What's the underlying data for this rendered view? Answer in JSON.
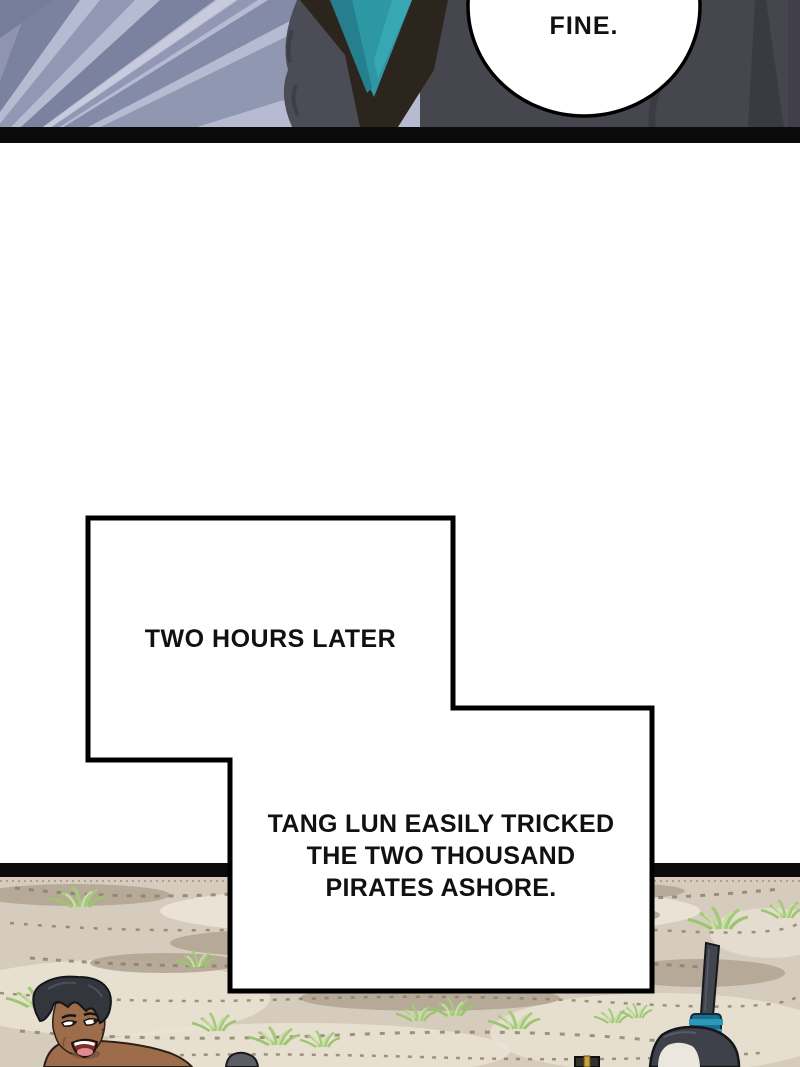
{
  "page": {
    "type": "webtoon comic page",
    "background_color": "#ffffff"
  },
  "top_panel": {
    "description": "character in dark coat with teal scarf seen close-up, speed-line background",
    "speech_bubble": {
      "text": "FINE."
    },
    "colors": {
      "speedline_bg": "#b7bbd2",
      "speedline_dark": "#7b82a0",
      "coat": "#46464e",
      "coat_left_lobe": "#4b4c56",
      "collar_dark": "#2c251d",
      "scarf_teal": "#2e97a4",
      "divider_bar": "#0b0b0b"
    }
  },
  "captions": {
    "box1": {
      "text": "TWO HOURS LATER"
    },
    "box2": {
      "lines": [
        "TANG LUN EASILY TRICKED",
        "THE TWO THOUSAND",
        "PIRATES ASHORE."
      ]
    },
    "border_color": "#000000",
    "fill_color": "#ffffff"
  },
  "bottom_panel": {
    "description": "sandy beach with grass tufts; laughing pirate at left, head and weapons at bottom edge",
    "figures": [
      "laughing-pirate-left",
      "head-top-center",
      "sword-pommel",
      "pirate-topknot-right"
    ],
    "colors": {
      "sand": "#d6ccbd",
      "sand_light": "#eae3d5",
      "sand_dark": "#b3a693",
      "speckle": "#8b7e6a",
      "grass": "#a4cb79",
      "grass_light": "#c6e0a2",
      "skin": "#9c6c4b",
      "hair": "#34363d",
      "mouth": "#7e2f2b",
      "wrap_blue": "#2b97bb",
      "divider_bar": "#0b0b0b"
    }
  }
}
